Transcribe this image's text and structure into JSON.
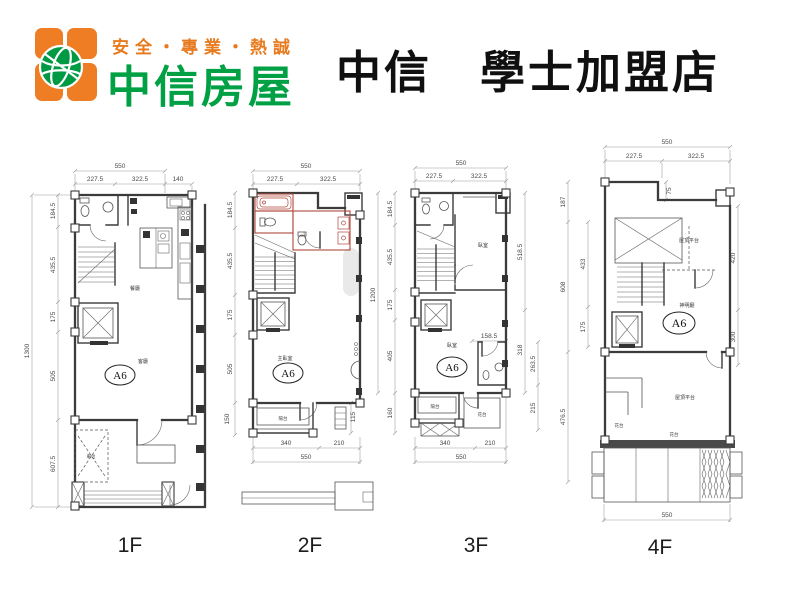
{
  "header": {
    "slogan": "安全・專業・熱誠",
    "brand": "中信房屋",
    "store_title": "中信　學士加盟店"
  },
  "unit_label": "A6",
  "colors": {
    "brand_orange": "#ee7d24",
    "brand_green": "#00a044",
    "highlight_red": "#b0473c"
  },
  "floors": [
    {
      "label": "1F",
      "dims": {
        "top_total": "550",
        "top_segs": [
          "227.5",
          "322.5",
          "140"
        ],
        "left_total": "1300",
        "left_segs": [
          "184.5",
          "435.5",
          "175",
          "505",
          "607.5"
        ]
      },
      "rooms": {
        "dining": "餐廳",
        "living": "客廳",
        "parking": "車位"
      }
    },
    {
      "label": "2F",
      "dims": {
        "top_total": "550",
        "top_segs": [
          "227.5",
          "322.5"
        ],
        "left_segs": [
          "184.5",
          "435.5",
          "175",
          "505",
          "150"
        ],
        "right_segs": [
          "115"
        ],
        "bottom_segs": [
          "340",
          "210"
        ],
        "bottom_total": "550"
      },
      "rooms": {
        "master": "主臥室",
        "balcony": "陽台"
      }
    },
    {
      "label": "3F",
      "dims": {
        "top_total": "550",
        "top_segs": [
          "227.5",
          "322.5"
        ],
        "left_total": "1200",
        "left_segs": [
          "184.5",
          "435.5",
          "175",
          "405",
          "160"
        ],
        "right_segs": [
          "518.5",
          "318"
        ],
        "bath_width": "158.5",
        "bath_segs": [
          "263.5",
          "215"
        ],
        "bottom_segs": [
          "340",
          "210"
        ],
        "bottom_total": "550"
      },
      "rooms": {
        "bedroom_upper": "臥室",
        "bedroom_lower": "臥室",
        "balcony": "陽台",
        "flower": "花台"
      }
    },
    {
      "label": "4F",
      "dims": {
        "top_total": "550",
        "top_segs": [
          "227.5",
          "322.5"
        ],
        "step": "75",
        "left_outer": [
          "187",
          "608",
          "476.5"
        ],
        "left_inner": [
          "433",
          "175"
        ],
        "right_segs": [
          "420",
          "300"
        ],
        "bottom_total": "550"
      },
      "rooms": {
        "roof_upper": "屋頂平台",
        "shrine": "神明廳",
        "roof_lower": "屋頂平台",
        "flower_left": "花台",
        "flower_right": "花台"
      }
    }
  ]
}
